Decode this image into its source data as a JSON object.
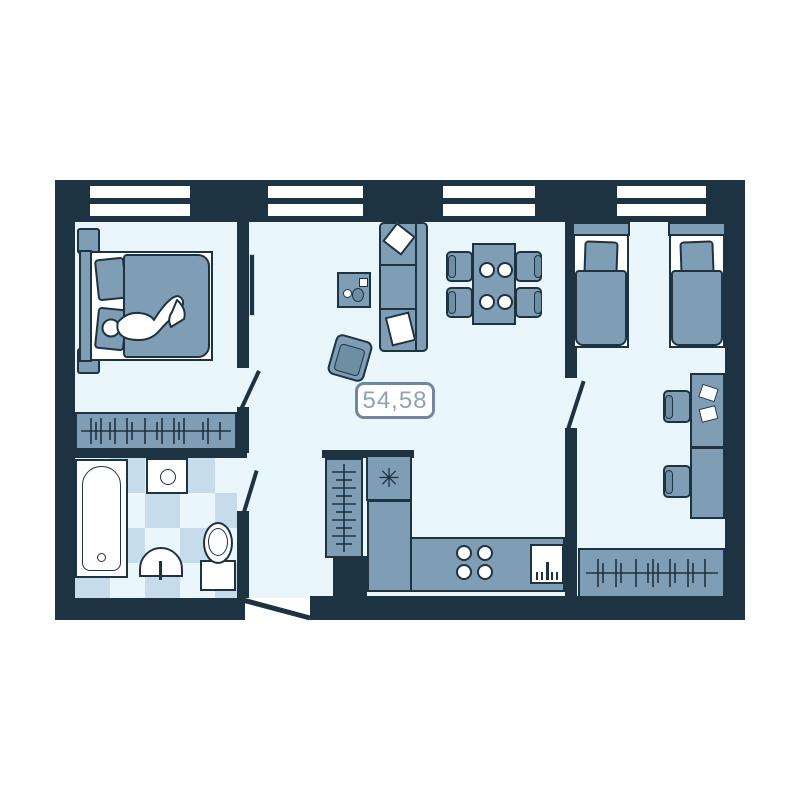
{
  "plan": {
    "area_label": "54,58",
    "symbols": {
      "fridge_snowflake": "✳"
    },
    "colors": {
      "background": "#ffffff",
      "wall": "#1e3342",
      "floor": "#e9f6fc",
      "furniture": "#7f9db4",
      "furniture_shadow": "#6e8ea4",
      "tile": "#c6dcea",
      "white": "#ffffff",
      "label_border": "#72879a",
      "label_text": "#8da4b4"
    }
  }
}
